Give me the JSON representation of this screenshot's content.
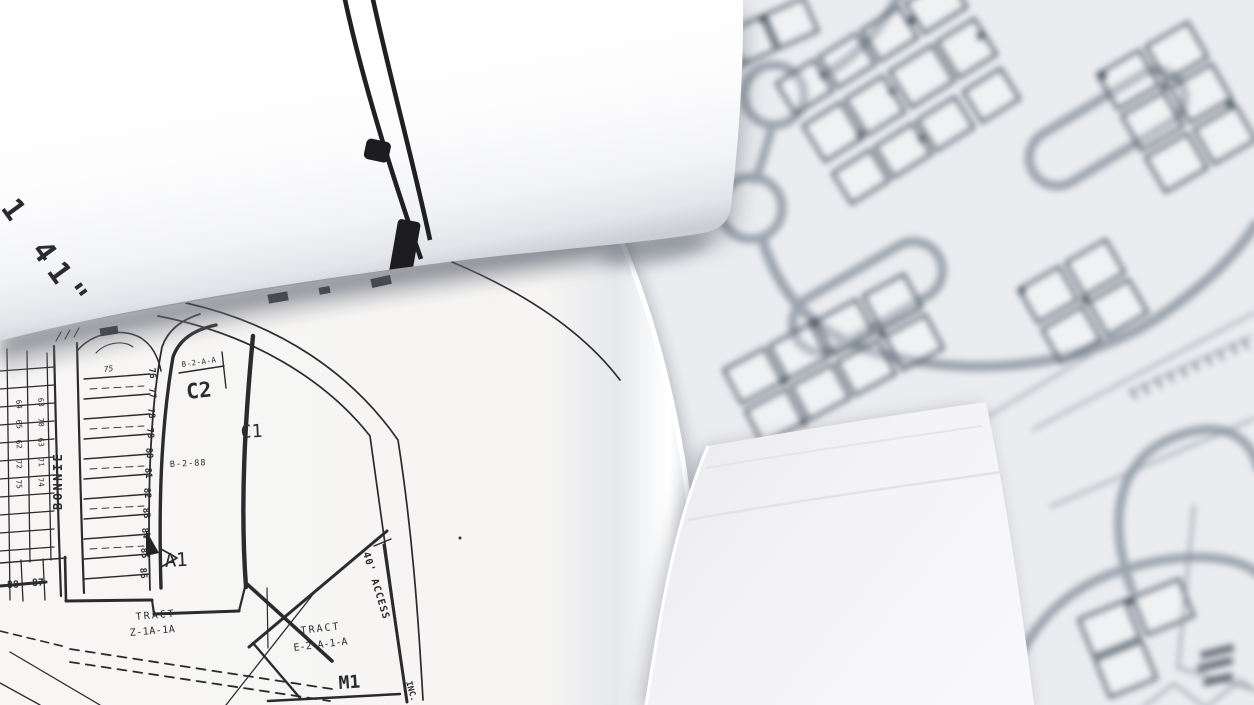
{
  "colors": {
    "paper_background": "#e8eaee",
    "map_ink": "#2b2b2f",
    "background_road": "#9ba4af",
    "background_building": "#4e5a67",
    "sheet_white": "#fdfdfe"
  },
  "top_sheet": {
    "edge_label": "1 41\""
  },
  "plat": {
    "street": "BONNIE",
    "zones": {
      "c2": "C2",
      "c1": "C1",
      "a1": "A1",
      "m1": "M1"
    },
    "notes": {
      "b2aa": "B-2-A-A",
      "b288": "B-2-88",
      "access": "40' ACCESS",
      "inc": "INC."
    },
    "tract_z": {
      "l1": "TRACT",
      "l2": "Z-1A-1A"
    },
    "tract_e": {
      "l1": "TRACT",
      "l2": "E-2-A-1-A"
    },
    "lots_right": [
      "76",
      "77",
      "78",
      "79",
      "80",
      "81",
      "82",
      "83",
      "84",
      "85",
      "86"
    ],
    "lots_top": [
      "75"
    ],
    "lots_bottom": [
      "88",
      "87"
    ],
    "lots_left": [
      "64",
      "63",
      "65",
      "70",
      "62",
      "63",
      "72",
      "71",
      "75",
      "74"
    ]
  }
}
